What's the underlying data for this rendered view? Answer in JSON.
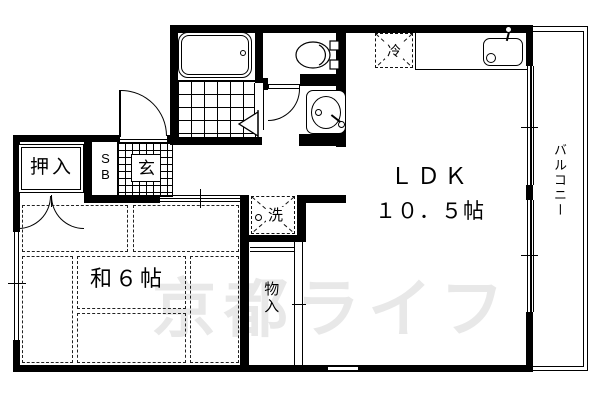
{
  "plan": {
    "watermark": "京都ライフ",
    "colors": {
      "wall": "#000000",
      "watermark": "#e8e8e8",
      "background": "#ffffff"
    },
    "rooms": {
      "ldk": {
        "label": "ＬＤＫ",
        "size": "１０．５帖"
      },
      "washitsu": {
        "label": "和６帖"
      },
      "balcony": {
        "label": "バルコニー"
      },
      "oshiire": {
        "label": "押入"
      },
      "monoire": {
        "label": "物入"
      },
      "genkan": {
        "label": "玄"
      },
      "shoebox": {
        "label": "SB"
      },
      "washer": {
        "label": "洗"
      },
      "fridge": {
        "label": "冷"
      }
    }
  }
}
